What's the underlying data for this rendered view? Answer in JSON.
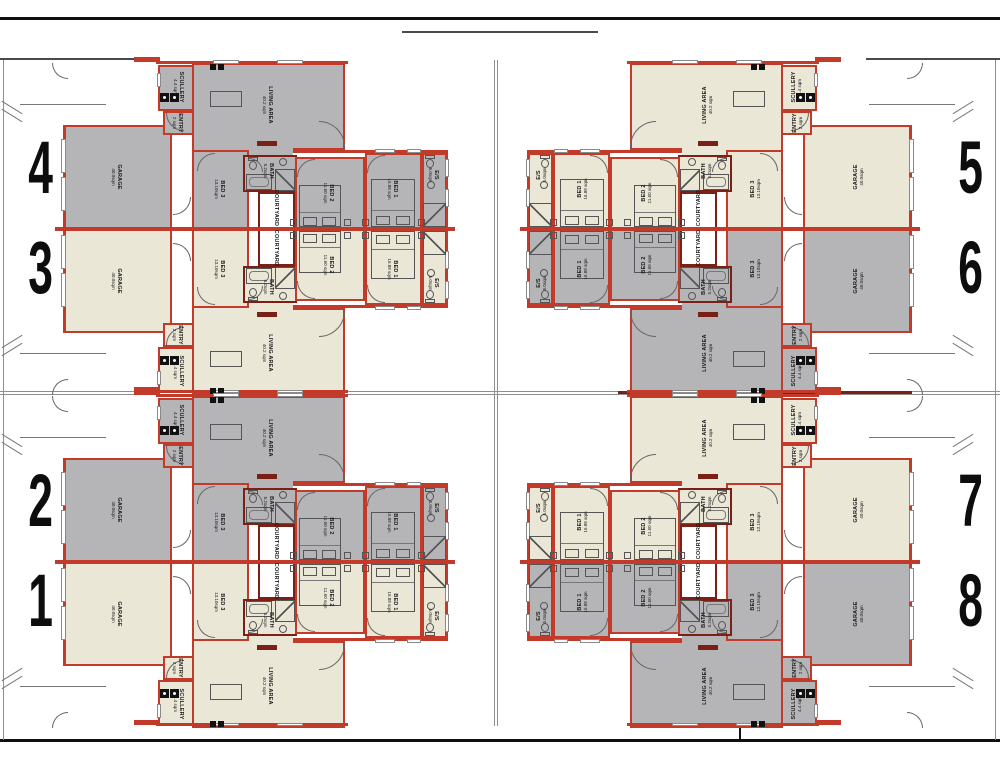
{
  "drawing": {
    "title": "8-unit residential floor plan",
    "rooms": {
      "garage": {
        "name": "GARAGE",
        "area": "40.0sqm"
      },
      "scullery": {
        "name": "SCULLERY",
        "area": "4.4 sqm"
      },
      "entry": {
        "name": "ENTRY",
        "area": "2 sqm"
      },
      "living": {
        "name": "LIVING AREA",
        "area": "40.2 sqm"
      },
      "bed3": {
        "name": "BED 3",
        "area": "13.10sqm"
      },
      "bath": {
        "name": "BATH",
        "area": "5.2sqm"
      },
      "bed2": {
        "name": "BED 2",
        "area": "11.60 sqm"
      },
      "bed1": {
        "name": "BED 1",
        "area": "16.88 sqm"
      },
      "es": {
        "name": "E/S",
        "area": "5.0sqm"
      },
      "courtyard": {
        "name": "COURTYARD"
      }
    },
    "blocks": [
      {
        "position": "top-left",
        "top_unit": "4",
        "bottom_unit": "3"
      },
      {
        "position": "top-right",
        "top_unit": "5",
        "bottom_unit": "6"
      },
      {
        "position": "bottom-left",
        "top_unit": "2",
        "bottom_unit": "1"
      },
      {
        "position": "bottom-right",
        "top_unit": "7",
        "bottom_unit": "8"
      }
    ],
    "colors": {
      "wall": "#c23b2a",
      "wall_dark": "#7a2017",
      "unit_gray": "#b5b5b8",
      "unit_cream": "#eae7d6",
      "boundary": "#8e8e8e",
      "number_black": "#0d0d0d"
    }
  }
}
